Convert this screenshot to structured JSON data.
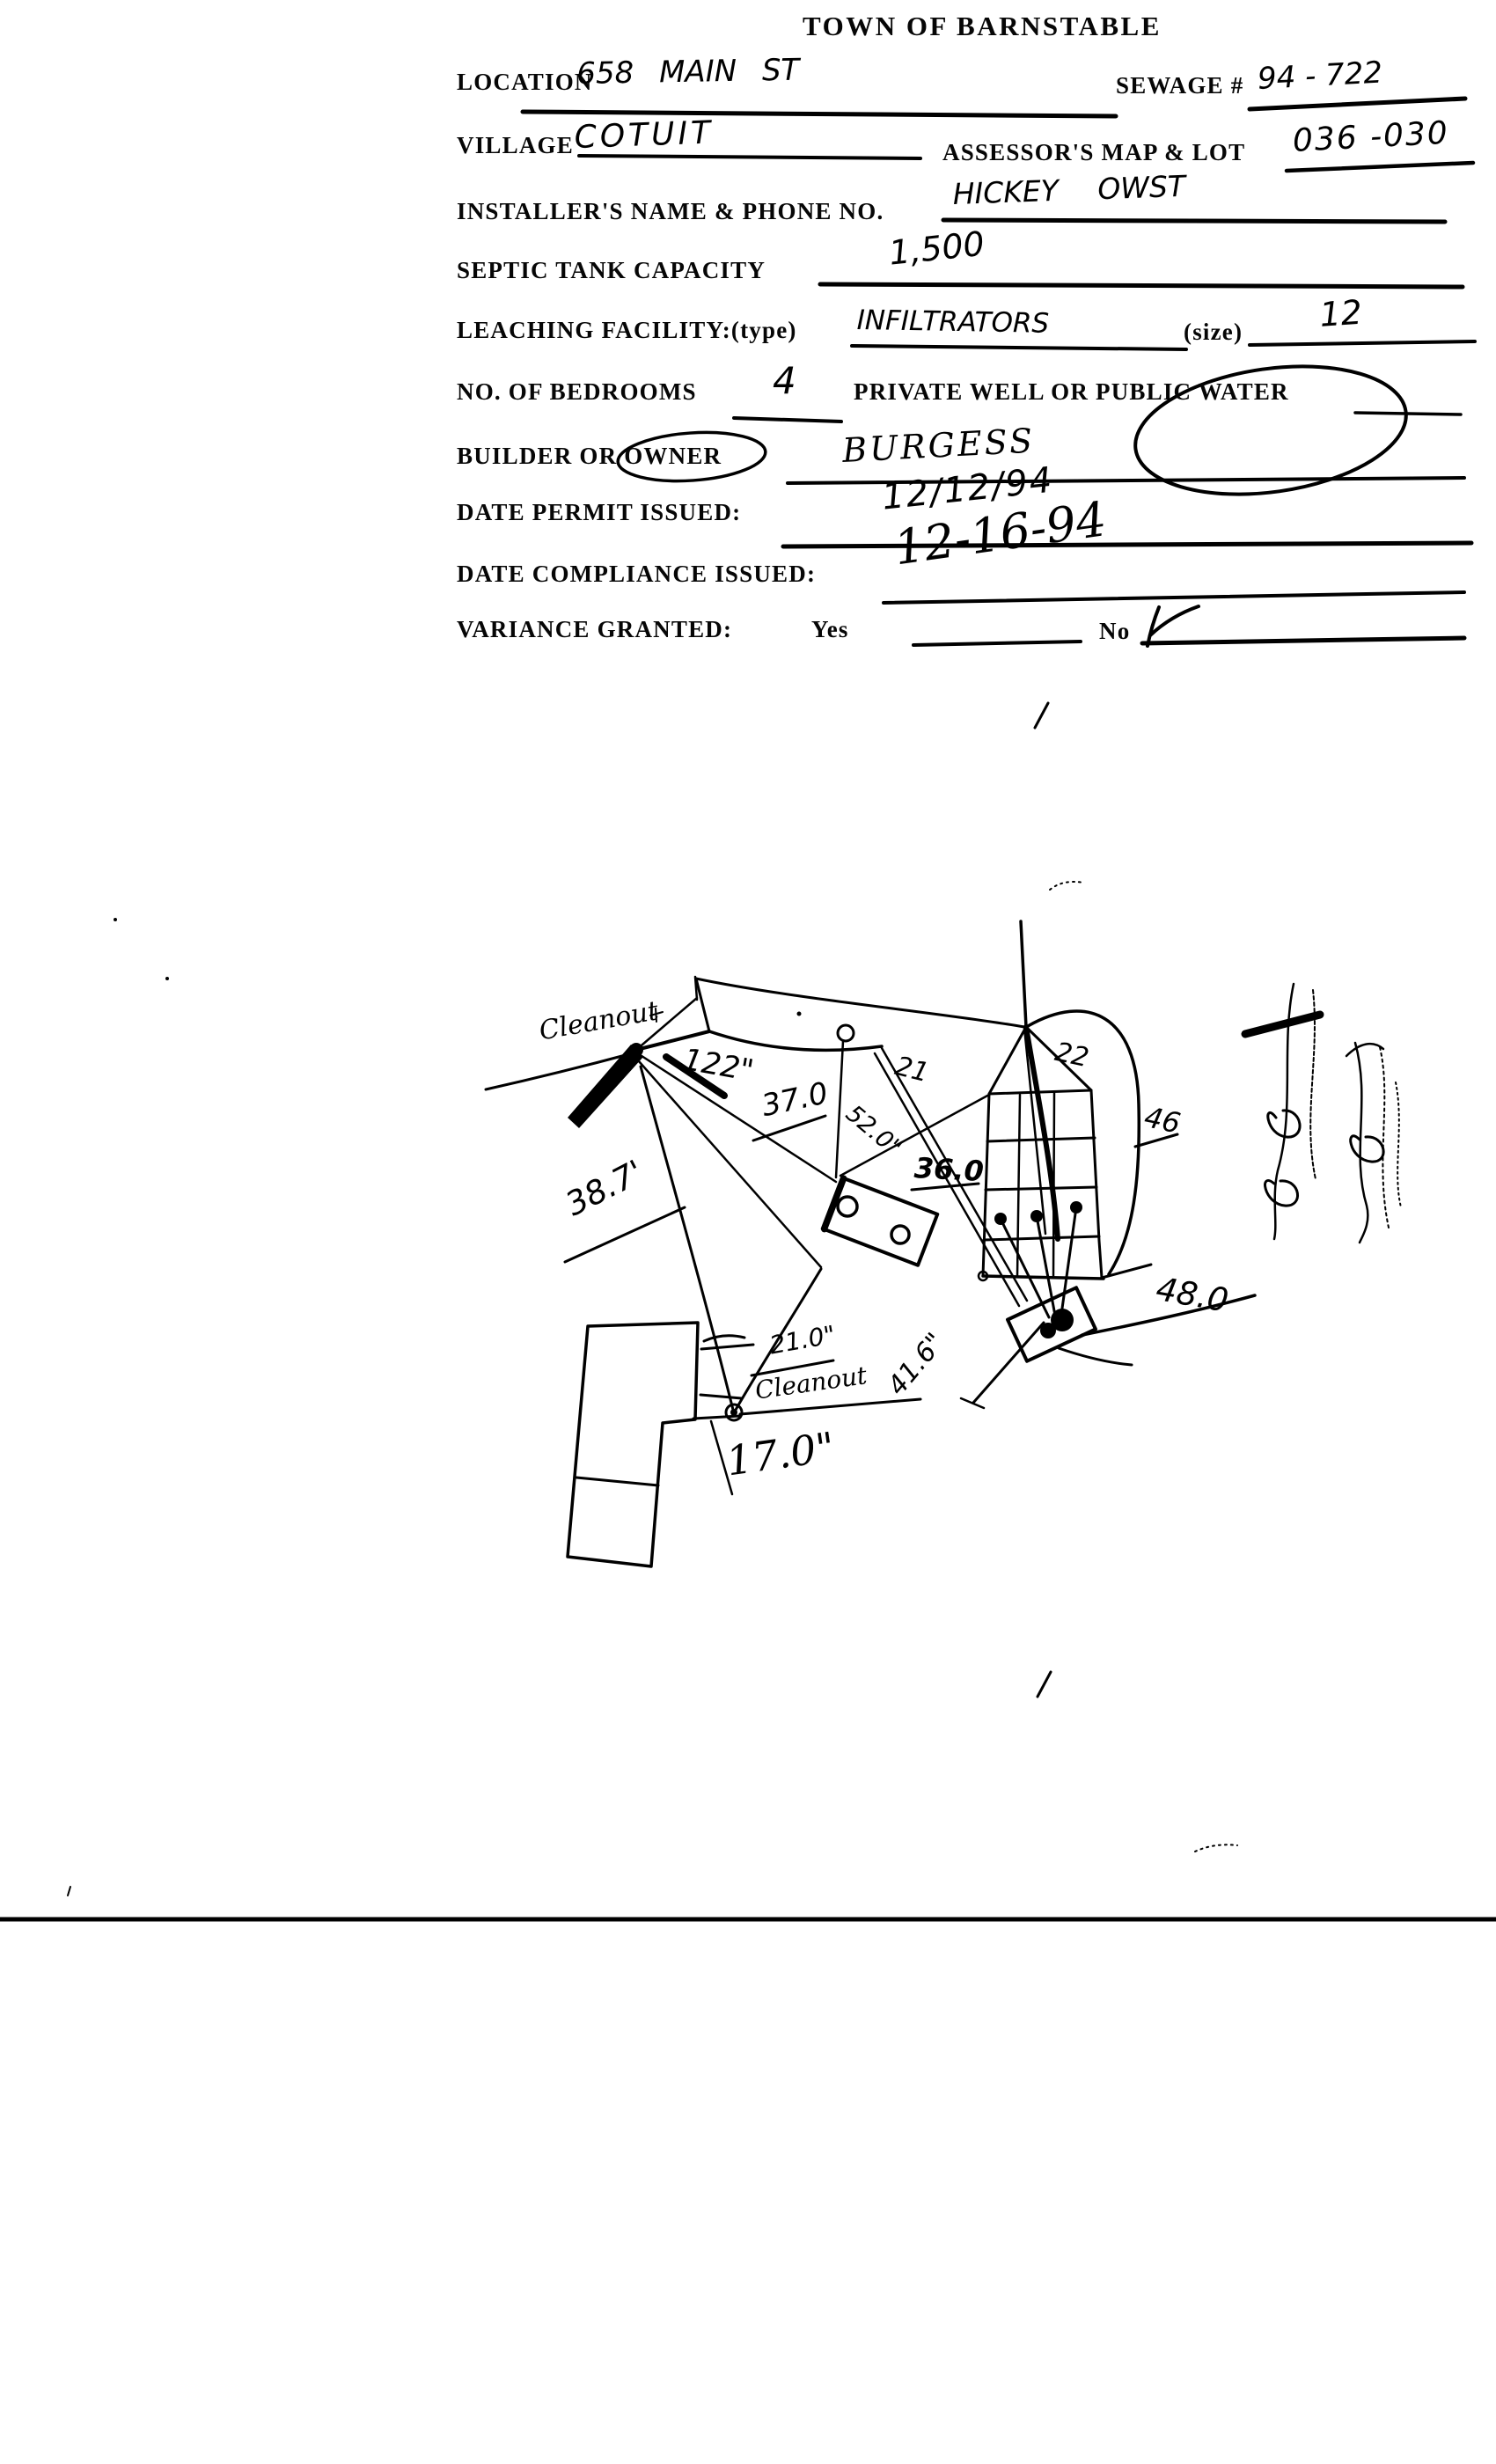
{
  "title": "TOWN OF BARNSTABLE",
  "form": {
    "location": {
      "label": "LOCATION",
      "value": "658 MAIN ST"
    },
    "sewage": {
      "label": "SEWAGE #",
      "value": "94 - 722"
    },
    "village": {
      "label": "VILLAGE",
      "value": "COTUIT"
    },
    "assessors": {
      "label": "ASSESSOR'S MAP & LOT",
      "value": "036 -030"
    },
    "installer": {
      "label": "INSTALLER'S NAME & PHONE NO.",
      "value": "HICKEY OWST"
    },
    "septic_capacity": {
      "label": "SEPTIC TANK CAPACITY",
      "value": "1,500"
    },
    "leaching": {
      "label": "LEACHING FACILITY:(type)",
      "type_value": "INFILTRATORS",
      "size_label": "(size)",
      "size_value": "12"
    },
    "bedrooms": {
      "label": "NO. OF BEDROOMS",
      "value": "4"
    },
    "water": {
      "label_prefix": "PRIVATE WELL OR",
      "circled": "PUBLIC WATER"
    },
    "builder": {
      "label_prefix": "BUILDER OR",
      "circled": "OWNER",
      "value": "BURGESS"
    },
    "permit": {
      "label": "DATE PERMIT ISSUED:",
      "value": "12/12/94"
    },
    "compliance": {
      "label": "DATE  COMPLIANCE ISSUED:",
      "value": "12-16-94"
    },
    "variance": {
      "label": "VARIANCE GRANTED:",
      "yes_label": "Yes",
      "no_label": "No",
      "granted": "No"
    }
  },
  "sketch": {
    "annotations": [
      {
        "id": "cleanout-upper",
        "text": "Cleanout"
      },
      {
        "id": "dim-122",
        "text": "122\""
      },
      {
        "id": "dim-37-0",
        "text": "37.0"
      },
      {
        "id": "dim-38-7",
        "text": "38.7'"
      },
      {
        "id": "dim-21",
        "text": "21"
      },
      {
        "id": "dim-22",
        "text": "22"
      },
      {
        "id": "dim-52-0",
        "text": "52.0\""
      },
      {
        "id": "dim-36-0",
        "text": "36.0"
      },
      {
        "id": "dim-46",
        "text": "46"
      },
      {
        "id": "dim-48-0",
        "text": "48.0"
      },
      {
        "id": "dim-21-0",
        "text": "21.0\""
      },
      {
        "id": "cleanout-lower",
        "text": "Cleanout"
      },
      {
        "id": "dim-41-6",
        "text": "41.6\""
      },
      {
        "id": "dim-17-0",
        "text": "17.0\""
      }
    ]
  },
  "colors": {
    "ink": "#000000",
    "paper": "#ffffff"
  }
}
